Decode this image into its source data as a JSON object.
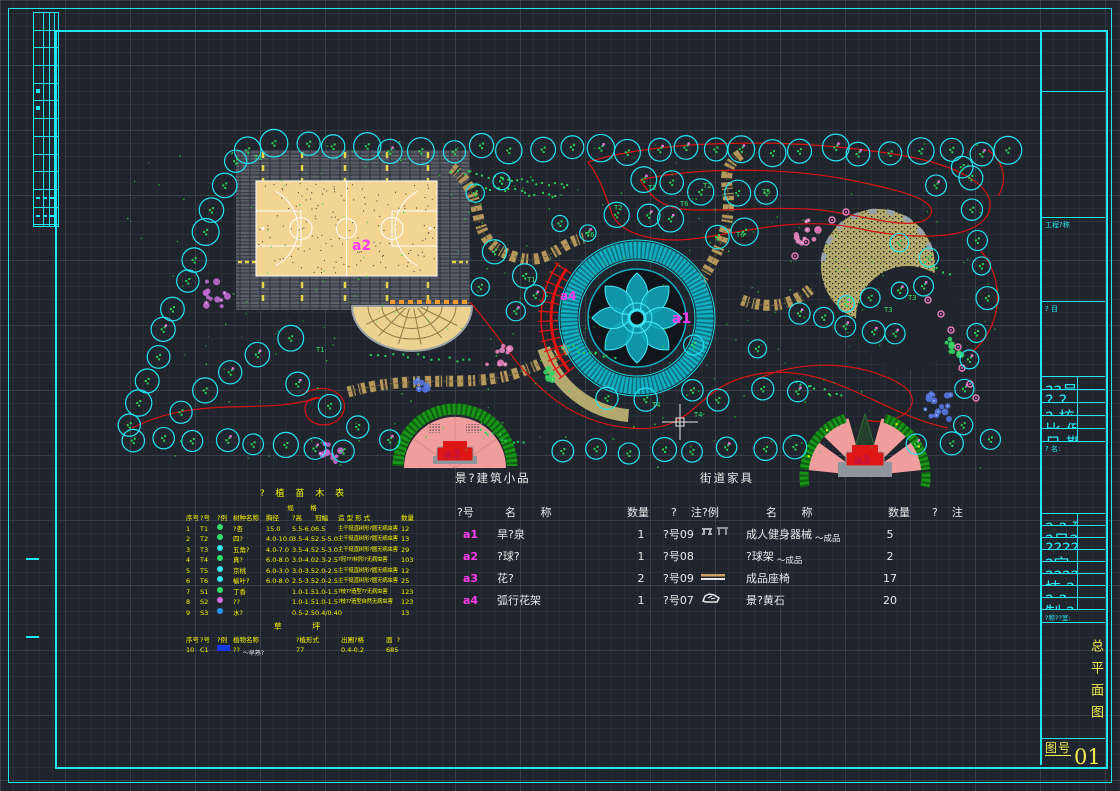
{
  "title_block": {
    "project_label": "工程?称",
    "item_label": "? 目",
    "info_rows": [
      "??号",
      "? ?",
      "? 核",
      "比 例",
      "日 期"
    ],
    "name_label": "? 名:",
    "sign_rows": [
      "? ? 班",
      "?日??人",
      "??????",
      "?定 人",
      "????人",
      "技 ? 人",
      "? ? 人",
      "制 ? 人"
    ],
    "studio_label": "?称??室:",
    "drawing_title": "总平面图",
    "sheet_label": "图号",
    "sheet_number": "01"
  },
  "plan": {
    "labels": {
      "a1": "a1",
      "a2": "a2",
      "a3_left": "a3",
      "a3_right": "a3",
      "a4": "a4"
    },
    "tree_tags": [
      "T1",
      "T2",
      "T3",
      "T4",
      "T5",
      "T6"
    ],
    "colors": {
      "tree_outline": "#24e4f2",
      "contour": "#d41414",
      "court": "#f2d493",
      "paving": "#565b64",
      "plaza_ring": "#12aec2",
      "pink_plaza": "#f09d9d",
      "hedge": "#189418",
      "path": "#b5975c",
      "dome": "#b3aa6c",
      "label_magenta": "#ff3df0",
      "label_red": "#c41040",
      "frame_cyan": "#1fe6f2",
      "table_yellow": "#f5f500"
    }
  },
  "feature_table": {
    "title": "景?建筑小品",
    "headers": [
      "?号",
      "名       称",
      "数量",
      "?    注"
    ],
    "rows": [
      {
        "id": "a1",
        "name": "旱?泉",
        "qty": "1",
        "note": "?号09"
      },
      {
        "id": "a2",
        "name": "?球?",
        "qty": "1",
        "note": "?号08"
      },
      {
        "id": "a3",
        "name": "花?",
        "qty": "2",
        "note": "?号09"
      },
      {
        "id": "a4",
        "name": "弧行花架",
        "qty": "1",
        "note": "?号07"
      }
    ]
  },
  "furniture_table": {
    "title": "街道家具",
    "headers": [
      "?例",
      "名       称",
      "数量",
      "?    注"
    ],
    "rows": [
      {
        "icon": "fitness-equipment",
        "name": "成人健身器械",
        "annot": "成品",
        "qty": "5",
        "note": ""
      },
      {
        "icon": "",
        "name": "?球架",
        "annot": "成品",
        "qty": "2",
        "note": ""
      },
      {
        "icon": "bench",
        "name": "成品座椅",
        "annot": "",
        "qty": "17",
        "note": ""
      },
      {
        "icon": "rock",
        "name": "景?黄石",
        "annot": "",
        "qty": "20",
        "note": ""
      }
    ]
  },
  "plant_table": {
    "title": "? 植 苗 木 表",
    "spec_group_label": "规        格",
    "headers": [
      "序号",
      "?号",
      "?例",
      "树种名称",
      "胸径",
      "?高",
      "冠幅",
      "造 型 形 式",
      "数量"
    ],
    "rows": [
      {
        "seq": "1",
        "tag": "T1",
        "icon_color": "#35e06a",
        "name": "?杏",
        "dbh": "15.0",
        "height": "5.5-6.0",
        "crown": "6.5",
        "form": "主干挺直树形?圆无病虫害",
        "qty": "12"
      },
      {
        "seq": "2",
        "tag": "T2",
        "icon_color": "#35e06a",
        "name": "四?",
        "dbh": "4.0-10.0",
        "height": "3.5-4.5",
        "crown": "2.5-5.0",
        "form": "主干挺直树形?圆无病虫害",
        "qty": "13"
      },
      {
        "seq": "3",
        "tag": "T3",
        "icon_color": "#39e5f5",
        "name": "五角?",
        "dbh": "4.0-7.0",
        "height": "3.5-4.5",
        "crown": "2.5-3.0",
        "form": "主干挺直树形?圆无病虫害",
        "qty": "29"
      },
      {
        "seq": "4",
        "tag": "T4",
        "icon_color": "#35e06a",
        "name": "真?",
        "dbh": "6.0-8.0",
        "height": "3.0-4.0",
        "crown": "2.3-2.5",
        "form": "?冠???树形?无病虫害",
        "qty": "103"
      },
      {
        "seq": "5",
        "tag": "T5",
        "icon_color": "#39e5f5",
        "name": "京桃",
        "dbh": "6.0-3.0",
        "height": "3.0-3.5",
        "crown": "2.0-2.5",
        "form": "主干挺直树形?圆无病虫害",
        "qty": "12"
      },
      {
        "seq": "6",
        "tag": "T6",
        "icon_color": "#39e5f5",
        "name": "榆叶?",
        "dbh": "6.0-8.0",
        "height": "2.5-3.5",
        "crown": "2.0-2.5",
        "form": "主干挺直树形?圆无病虫害",
        "qty": "25"
      },
      {
        "seq": "7",
        "tag": "S1",
        "icon_color": "#35e06a",
        "name": "丁香",
        "dbh": "",
        "height": "1.0-1.5",
        "crown": "1.0-1.5",
        "form": "?枝??造型??无病虫害",
        "qty": "123"
      },
      {
        "seq": "8",
        "tag": "S2",
        "icon_color": "#d86fe0",
        "name": "??",
        "dbh": "",
        "height": "1.0-1.5",
        "crown": "1.0-1.5",
        "form": "?枝??造型自然无病虫害",
        "qty": "123"
      },
      {
        "seq": "9",
        "tag": "S3",
        "icon_color": "#2196f3",
        "name": "水?",
        "dbh": "",
        "height": "0.5-2.5",
        "crown": "0.4/0.40",
        "form": "",
        "qty": "13"
      }
    ],
    "lawn_title": "草    坪",
    "lawn_headers": [
      "序号",
      "?号",
      "?例",
      "植物名称",
      "?植形式",
      "出圃?格",
      "面  ?"
    ],
    "lawn_rows": [
      {
        "seq": "10",
        "tag": "C1",
        "name": "??",
        "annot": "早熟?",
        "plant_form": "77",
        "spec": "0.4-0.2",
        "area": "685"
      }
    ]
  }
}
